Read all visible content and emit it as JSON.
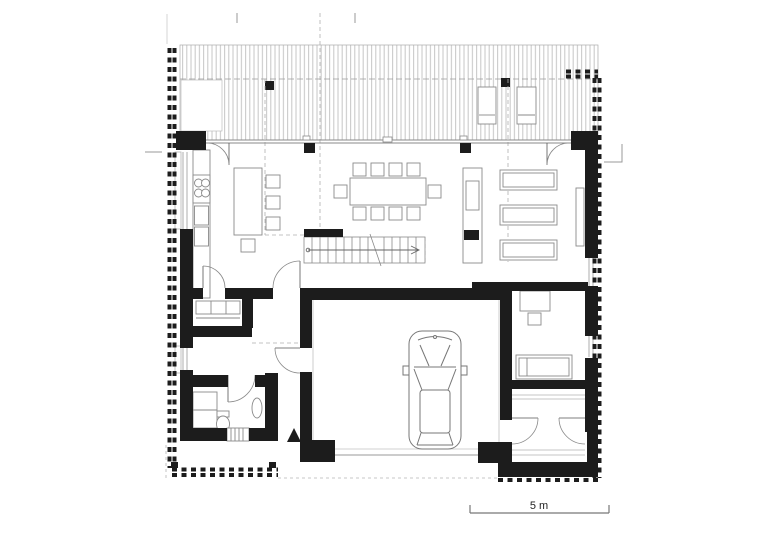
{
  "drawing": {
    "kind": "architectural-floor-plan",
    "scale_bar": {
      "label": "5 m"
    }
  },
  "colors": {
    "wall": "#1c1c1c",
    "boundary": "#1c1c1c",
    "furniture_line": "#8a8a8a",
    "thin_line": "#999999",
    "light_line": "#b5b5b5",
    "deck_stripe": "#c6c6c6",
    "marker": "#1c1c1c",
    "scale_text": "#222222",
    "background": "#ffffff"
  },
  "elements": {
    "property_boundary": "dashed black square fence markers around plot",
    "terrace": "wood deck with vertical plank hatching, two columns, two sun loungers",
    "glass_facade": "full-width glazing with two entrance doors and two mullions",
    "kitchen": "wall counter with 4-burner cooktop, cabinets, island with 4 bar stools",
    "dining": "table with 10 chairs",
    "staircase": "straight stair with direction arrow and handrail wall",
    "fireplace": "tall fireplace / media unit",
    "living_room": "three parallel sofas",
    "courtyard": "inner court / carport with parked car seen from above",
    "bathroom": "vanity counter, toilet, washbasin",
    "closet": "wardrobe shelving room",
    "study": "desk with chair and daybed",
    "entrance": "recessed entry with two swing doors and triangle marker",
    "scale_bar": "graphic scale labelled 5 m"
  }
}
